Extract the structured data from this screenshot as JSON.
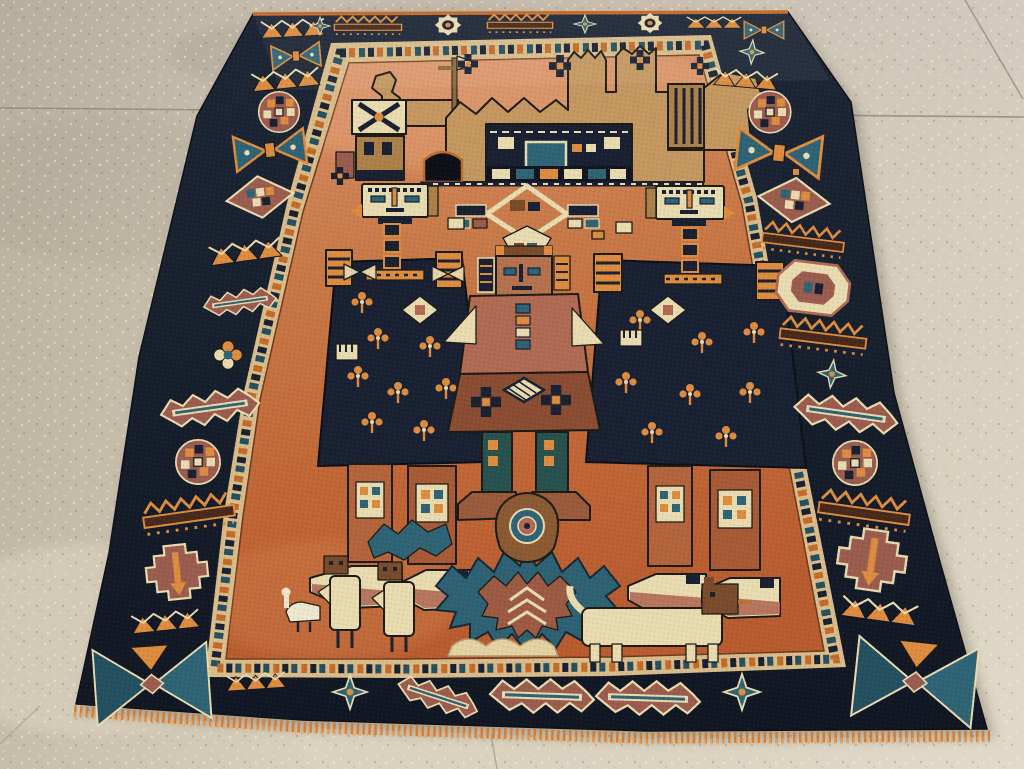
{
  "scene": {
    "photo": "Antique pictorial tribal rug displayed on a speckled stone floor",
    "floor": "Beige speckled terrazzo floor with joint seams",
    "rug": "Hand-knotted pictorial rug in perspective, narrow at top",
    "main_border": "Dark indigo border with geometric tribal motifs",
    "guard_band": "Ivory guard band with colored checker dashes",
    "field": "Rust-orange open field",
    "building": "Crenellated village building with towers, windows and arch door",
    "ornament": "Diamond lamp ornament between the figures",
    "left_figure": "Tall standing figure in dark indigo coat with striped epaulettes",
    "right_figure": "Tall standing figure in dark indigo coat with striped epaulettes",
    "central_figure": "Smaller central figure in brown robe with teal leggings",
    "palmette": "Large teal serrated palmette with brown eye medallion",
    "side_leaf": "Small teal serrated leaf",
    "birds": "Two ivory bird animals with brown heads",
    "goose": "Small white goose",
    "lion": "Long ivory lion with brown head",
    "fringe": "Orange knotted fringe along lower edge",
    "motifs": {
      "zigzag": "zigzag triangle row",
      "bowtie": "teal bow-tie medallion",
      "rosette": "checkered rosette medallion",
      "diamond": "diamond lattice medallion",
      "leaf": "serrated leaf",
      "comb": "zigzag comb bar",
      "stepped": "stepped cross medallion",
      "gear": "ivory gear rosette",
      "star": "eight point star",
      "octagon": "octagon medallion",
      "hourglass": "corner hourglass triangles",
      "sprig": "orange blossom sprig",
      "navyflower": "indigo cross blossom"
    }
  },
  "palette": {
    "floorA": "#c6bdae",
    "floorB": "#cdc4b1",
    "floorC": "#d2c9b5",
    "floorD": "#dad2bf",
    "speckLight": "#f0ead9",
    "speckDark": "#756d5c",
    "seam": "#857d6b",
    "shadow": "#55503f",
    "navy": "#182032",
    "navyDeep": "#10151f",
    "outline": "#1b1b14",
    "teal": "#2e6375",
    "tealDeep": "#234f60",
    "greenTeal": "#27514e",
    "field": "#c26c3b",
    "fieldTop": "#d8916a",
    "fieldDeep": "#b55c2e",
    "tan": "#c49760",
    "tanDark": "#ab8049",
    "cream": "#e9dbb0",
    "creamDark": "#d5bf8c",
    "mauve": "#9a5c4e",
    "rose": "#b06a54",
    "orange": "#dd8c3e",
    "orangeDeep": "#c26b2a",
    "brown": "#7a4a2c",
    "darkBrown": "#46291a",
    "rust": "#b3643c",
    "rustDark": "#a85a36",
    "face": "#b4714f",
    "fringe": "#d07b36",
    "guard": "#d9bc8a"
  }
}
